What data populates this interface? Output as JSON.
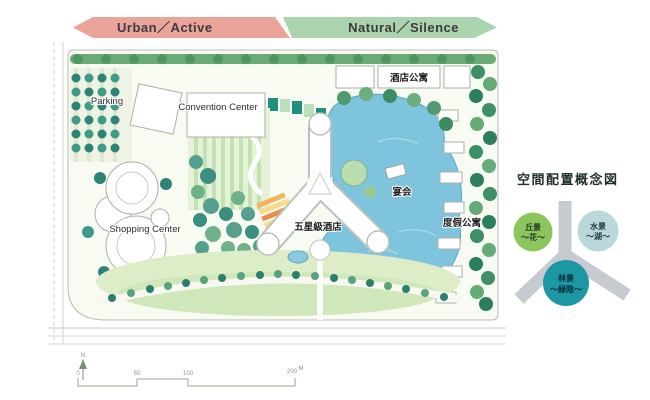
{
  "banner": {
    "urban": {
      "label": "Urban／Active",
      "color": "#eba49a"
    },
    "natural": {
      "label": "Natural／Silence",
      "color": "#abd3ad"
    }
  },
  "plan": {
    "labels": {
      "parking": "Parking",
      "convention_center": "Convention Center",
      "shopping_center": "Shopping Center",
      "hotel": "五星級酒店",
      "banquet": "宴会",
      "hotel_apartments": "酒店公寓",
      "resort_apartments": "度假公寓"
    },
    "north": "N",
    "scale": {
      "ticks": [
        "0",
        "50",
        "100",
        "200"
      ],
      "unit": "M"
    }
  },
  "concept": {
    "title": "空間配置概念図",
    "circles": [
      {
        "label_line1": "丘景",
        "label_line2": "〜花〜",
        "color": "#8cc45e",
        "text_color": "#223a26"
      },
      {
        "label_line1": "水景",
        "label_line2": "〜湖〜",
        "color": "#bad8da",
        "text_color": "#1f3a40"
      },
      {
        "label_line1": "林景",
        "label_line2": "〜緑陰〜",
        "color": "#1d97a4",
        "text_color": "#062f37"
      }
    ]
  }
}
